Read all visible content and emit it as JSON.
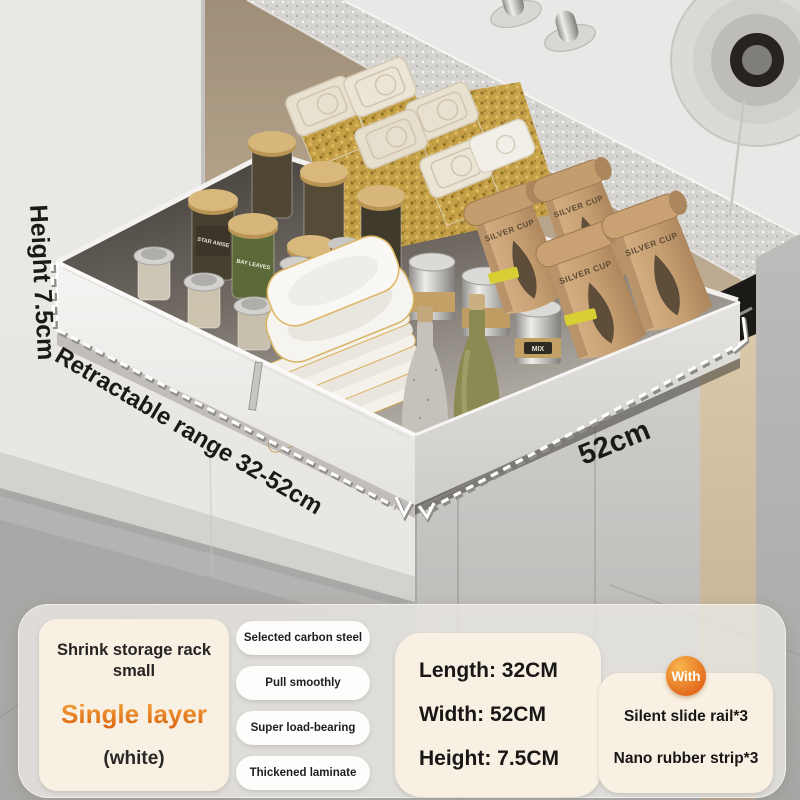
{
  "product_annotations": {
    "height": "Height 7.5cm",
    "range": "Retractable range 32-52cm",
    "width": "52cm"
  },
  "photo_labels": {
    "coffee_bag_brand": "SILVER CUP",
    "spice_jar_star_anise": "STAR ANISE",
    "spice_jar_bay_leaves": "BAY LEAVES",
    "chilli_jar": "CHILLI PEPPER",
    "canister": "MIX"
  },
  "info_panel": {
    "product_card": {
      "title": "Shrink storage rack small",
      "variant": "Single layer",
      "color_option": "(white)"
    },
    "features": [
      "Selected carbon steel",
      "Pull smoothly",
      "Super load-bearing",
      "Thickened laminate"
    ],
    "dimensions": [
      "Length: 32CM",
      "Width: 52CM",
      "Height: 7.5CM"
    ],
    "included": {
      "badge": "With",
      "items": [
        "Silent slide rail*3",
        "Nano rubber strip*3"
      ]
    }
  },
  "colors": {
    "accent_orange": "#e8791c",
    "badge_orange_top": "#f9b54d",
    "badge_orange_bottom": "#e2661a",
    "card_cream": "#f8f0e2",
    "pill_white": "#fdfdfc",
    "cabinet_tan": "#b3a28b",
    "floor_grey": "#a9a8a6"
  }
}
